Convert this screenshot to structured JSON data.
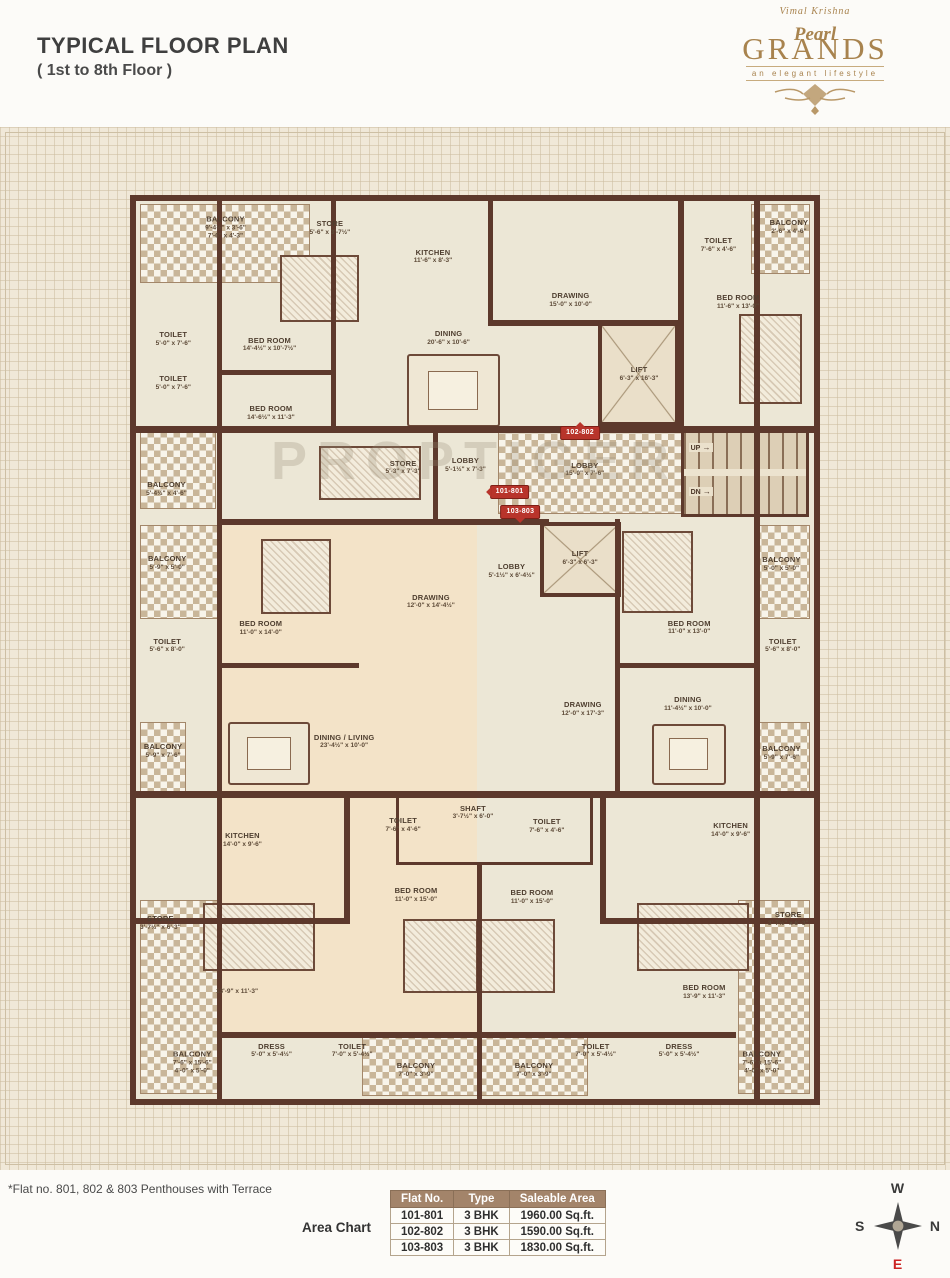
{
  "header": {
    "title": "TYPICAL FLOOR PLAN",
    "subtitle": "( 1st to 8th Floor )",
    "logo": {
      "pre": "Vimal Krishna",
      "script": "Pearl",
      "main": "GRANDS",
      "tagline": "an elegant lifestyle"
    }
  },
  "plan": {
    "watermark": "PROPTIGER",
    "stairs": {
      "up": "UP",
      "dn": "DN"
    },
    "flat_tags": [
      {
        "label": "102-802",
        "dir": "up",
        "x": 65.5,
        "y": 25.8
      },
      {
        "label": "101-801",
        "dir": "left",
        "x": 55.1,
        "y": 32.4
      },
      {
        "label": "103-803",
        "dir": "down",
        "x": 56.7,
        "y": 34.6
      }
    ],
    "rooms": [
      {
        "name": "BALCONY",
        "dims": "9'-4½\" x 3'-6\"",
        "dims2": "7'-6\" x 4'-3\"",
        "x": 13.2,
        "y": 3.0
      },
      {
        "name": "STORE",
        "dims": "5'-6\" x 3'-7½\"",
        "x": 28.6,
        "y": 3.0
      },
      {
        "name": "KITCHEN",
        "dims": "11'-6\" x 8'-3\"",
        "x": 43.8,
        "y": 6.2
      },
      {
        "name": "DRAWING",
        "dims": "15'-0\" x 10'-0\"",
        "x": 64.1,
        "y": 11.0
      },
      {
        "name": "TOILET",
        "dims": "7'-6\" x 4'-6\"",
        "x": 85.9,
        "y": 4.9
      },
      {
        "name": "BALCONY",
        "dims": "2'-6\" x 4'-6\"",
        "x": 96.3,
        "y": 2.9
      },
      {
        "name": "BED ROOM",
        "dims": "11'-6\" x 13'-0\"",
        "x": 88.8,
        "y": 11.3
      },
      {
        "name": "TOILET",
        "dims": "5'-0\" x 7'-6\"",
        "x": 5.5,
        "y": 15.4
      },
      {
        "name": "BED ROOM",
        "dims": "14'-4½\" x 10'-7½\"",
        "x": 19.7,
        "y": 16.0
      },
      {
        "name": "DINING",
        "dims": "20'-6\" x 10'-6\"",
        "x": 46.1,
        "y": 15.3
      },
      {
        "name": "TOILET",
        "dims": "5'-0\" x 7'-6\"",
        "x": 5.5,
        "y": 20.3
      },
      {
        "name": "BED ROOM",
        "dims": "14'-6½\" x 11'-3\"",
        "x": 19.9,
        "y": 23.6
      },
      {
        "name": "LIFT",
        "dims": "6'-3\" x 16'-3\"",
        "x": 74.2,
        "y": 19.3
      },
      {
        "name": "BALCONY",
        "dims": "5'-4½\" x 4'-6\"",
        "x": 4.5,
        "y": 32.1
      },
      {
        "name": "STORE",
        "dims": "5'-3\" x 7'-3\"",
        "x": 39.4,
        "y": 29.7
      },
      {
        "name": "LOBBY",
        "dims": "5'-1½\" x 7'-3\"",
        "x": 48.6,
        "y": 29.4
      },
      {
        "name": "LOBBY",
        "dims": "15'-0\" x 7'-6\"",
        "x": 66.2,
        "y": 29.9
      },
      {
        "name": "BALCONY",
        "dims": "5'-9\" x 5'-0\"",
        "x": 4.6,
        "y": 40.3
      },
      {
        "name": "LIFT",
        "dims": "6'-3\" x 6'-3\"",
        "x": 65.5,
        "y": 39.8
      },
      {
        "name": "LOBBY",
        "dims": "5'-1½\" x 6'-4½\"",
        "x": 55.4,
        "y": 41.2
      },
      {
        "name": "BED ROOM",
        "dims": "11'-0\" x 14'-0\"",
        "x": 18.4,
        "y": 47.6
      },
      {
        "name": "DRAWING",
        "dims": "12'-0\" x 14'-4½\"",
        "x": 43.5,
        "y": 44.6
      },
      {
        "name": "BED ROOM",
        "dims": "11'-0\" x 13'-0\"",
        "x": 81.6,
        "y": 47.5
      },
      {
        "name": "BALCONY",
        "dims": "5'-0\" x 5'-0\"",
        "x": 95.2,
        "y": 40.4
      },
      {
        "name": "TOILET",
        "dims": "5'-6\" x 8'-0\"",
        "x": 4.6,
        "y": 49.5
      },
      {
        "name": "TOILET",
        "dims": "5'-6\" x 8'-0\"",
        "x": 95.4,
        "y": 49.5
      },
      {
        "name": "DRAWING",
        "dims": "12'-0\" x 17'-3\"",
        "x": 65.9,
        "y": 56.6
      },
      {
        "name": "DINING",
        "dims": "11'-4½\" x 10'-0\"",
        "x": 81.4,
        "y": 56.0
      },
      {
        "name": "DINING / LIVING",
        "dims": "23'-4½\" x 10'-0\"",
        "x": 30.7,
        "y": 60.2
      },
      {
        "name": "BALCONY",
        "dims": "5'-9\" x 7'-6\"",
        "x": 4.0,
        "y": 61.3
      },
      {
        "name": "BALCONY",
        "dims": "5'-9\" x 7'-6\"",
        "x": 95.2,
        "y": 61.5
      },
      {
        "name": "KITCHEN",
        "dims": "14'-0\" x 9'-6\"",
        "x": 15.7,
        "y": 71.2
      },
      {
        "name": "TOILET",
        "dims": "7'-6\" x 4'-6\"",
        "x": 39.4,
        "y": 69.5
      },
      {
        "name": "SHAFT",
        "dims": "3'-7½\" x 6'-0\"",
        "x": 49.7,
        "y": 68.1
      },
      {
        "name": "TOILET",
        "dims": "7'-6\" x 4'-6\"",
        "x": 60.6,
        "y": 69.6
      },
      {
        "name": "KITCHEN",
        "dims": "14'-0\" x 9'-6\"",
        "x": 87.7,
        "y": 70.1
      },
      {
        "name": "STORE",
        "dims": "3'-7½\" x 6'-3\"",
        "x": 3.6,
        "y": 80.4
      },
      {
        "name": "STORE",
        "dims": "3'-7½\" x 6'-3\"",
        "x": 96.2,
        "y": 80.0
      },
      {
        "name": "BED ROOM",
        "dims": "11'-0\" x 15'-0\"",
        "x": 41.3,
        "y": 77.3
      },
      {
        "name": "BED ROOM",
        "dims": "11'-0\" x 15'-0\"",
        "x": 58.4,
        "y": 77.5
      },
      {
        "name": "",
        "dims": "13'-9\" x 11'-3\"",
        "x": 14.9,
        "y": 88.1
      },
      {
        "name": "BED ROOM",
        "dims": "13'-9\" x 11'-3\"",
        "x": 83.8,
        "y": 88.1
      },
      {
        "name": "DRESS",
        "dims": "5'-0\" x 5'-4½\"",
        "x": 20.0,
        "y": 94.6
      },
      {
        "name": "TOILET",
        "dims": "7'-0\" x 5'-4½\"",
        "x": 31.9,
        "y": 94.6
      },
      {
        "name": "TOILET",
        "dims": "7'-0\" x 5'-4½\"",
        "x": 67.8,
        "y": 94.6
      },
      {
        "name": "DRESS",
        "dims": "5'-0\" x 5'-4½\"",
        "x": 80.1,
        "y": 94.6
      },
      {
        "name": "BALCONY",
        "dims": "7'-6\" x 15'-6\"",
        "dims2": "4'-0\" x 5'-0\"",
        "x": 8.3,
        "y": 96.0
      },
      {
        "name": "BALCONY",
        "dims": "7'-6\" x 15'-6\"",
        "dims2": "4'-0\" x 5'-0\"",
        "x": 92.3,
        "y": 96.0
      },
      {
        "name": "BALCONY",
        "dims": "7'-0\" x 3'-9\"",
        "x": 41.3,
        "y": 96.8
      },
      {
        "name": "BALCONY",
        "dims": "7'-0\" x 3'-9\"",
        "x": 58.7,
        "y": 96.8
      }
    ]
  },
  "footer": {
    "note": "*Flat no. 801, 802 & 803 Penthouses with Terrace",
    "area_chart_label": "Area Chart",
    "table": {
      "headers": [
        "Flat No.",
        "Type",
        "Saleable Area"
      ],
      "rows": [
        [
          "101-801",
          "3 BHK",
          "1960.00 Sq.ft."
        ],
        [
          "102-802",
          "3 BHK",
          "1590.00 Sq.ft."
        ],
        [
          "103-803",
          "3 BHK",
          "1830.00 Sq.ft."
        ]
      ]
    },
    "compass": {
      "top": "W",
      "right": "N",
      "left": "S",
      "bottom": "E"
    }
  },
  "colors": {
    "wall": "#5d392c",
    "plan_bg": "#ece7d6",
    "flat_tint": "#f3e3c8",
    "tag_red": "#b8342b",
    "logo_gold": "#a8834e",
    "table_header": "#a3846a",
    "compass_east": "#cc2222"
  }
}
